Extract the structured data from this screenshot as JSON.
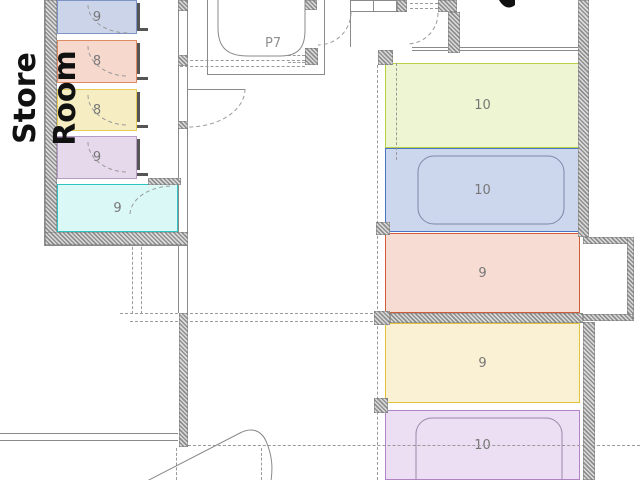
{
  "plan": {
    "side_label": "Store Room",
    "fixture_label": "P7",
    "left_rooms": [
      {
        "name": "store-room-blue",
        "number": "9"
      },
      {
        "name": "store-room-salmon",
        "number": "8"
      },
      {
        "name": "store-room-yellow",
        "number": "8"
      },
      {
        "name": "store-room-lavender",
        "number": "9"
      },
      {
        "name": "store-room-cyan",
        "number": "9"
      }
    ],
    "right_rooms": [
      {
        "name": "room-green",
        "number": "10"
      },
      {
        "name": "room-blue-bed",
        "number": "10"
      },
      {
        "name": "room-salmon",
        "number": "9"
      },
      {
        "name": "room-yellow",
        "number": "9"
      },
      {
        "name": "room-lavender-bed",
        "number": "10"
      }
    ],
    "colors": {
      "wall_hatch_gray": "#8f8f8f",
      "line_gray": "#8a8a8a",
      "number_gray": "#777777",
      "label_black": "#111111",
      "left_room_fills": [
        "#ccd4ea",
        "#f6d8cd",
        "#f6edc3",
        "#e6d9ec",
        "#d9f8f6"
      ],
      "left_room_borders": [
        "#7e93c6",
        "#e08a64",
        "#e3cc58",
        "#b89cc8",
        "#2fc4c0"
      ],
      "right_room_fills": [
        "#edf5d3",
        "#ccd6ec",
        "#f6dcd3",
        "#faf1d4",
        "#ecdff3"
      ],
      "right_room_borders": [
        "#b9d145",
        "#4a73c2",
        "#cc5f3a",
        "#e2c33e",
        "#b184c6"
      ]
    }
  }
}
